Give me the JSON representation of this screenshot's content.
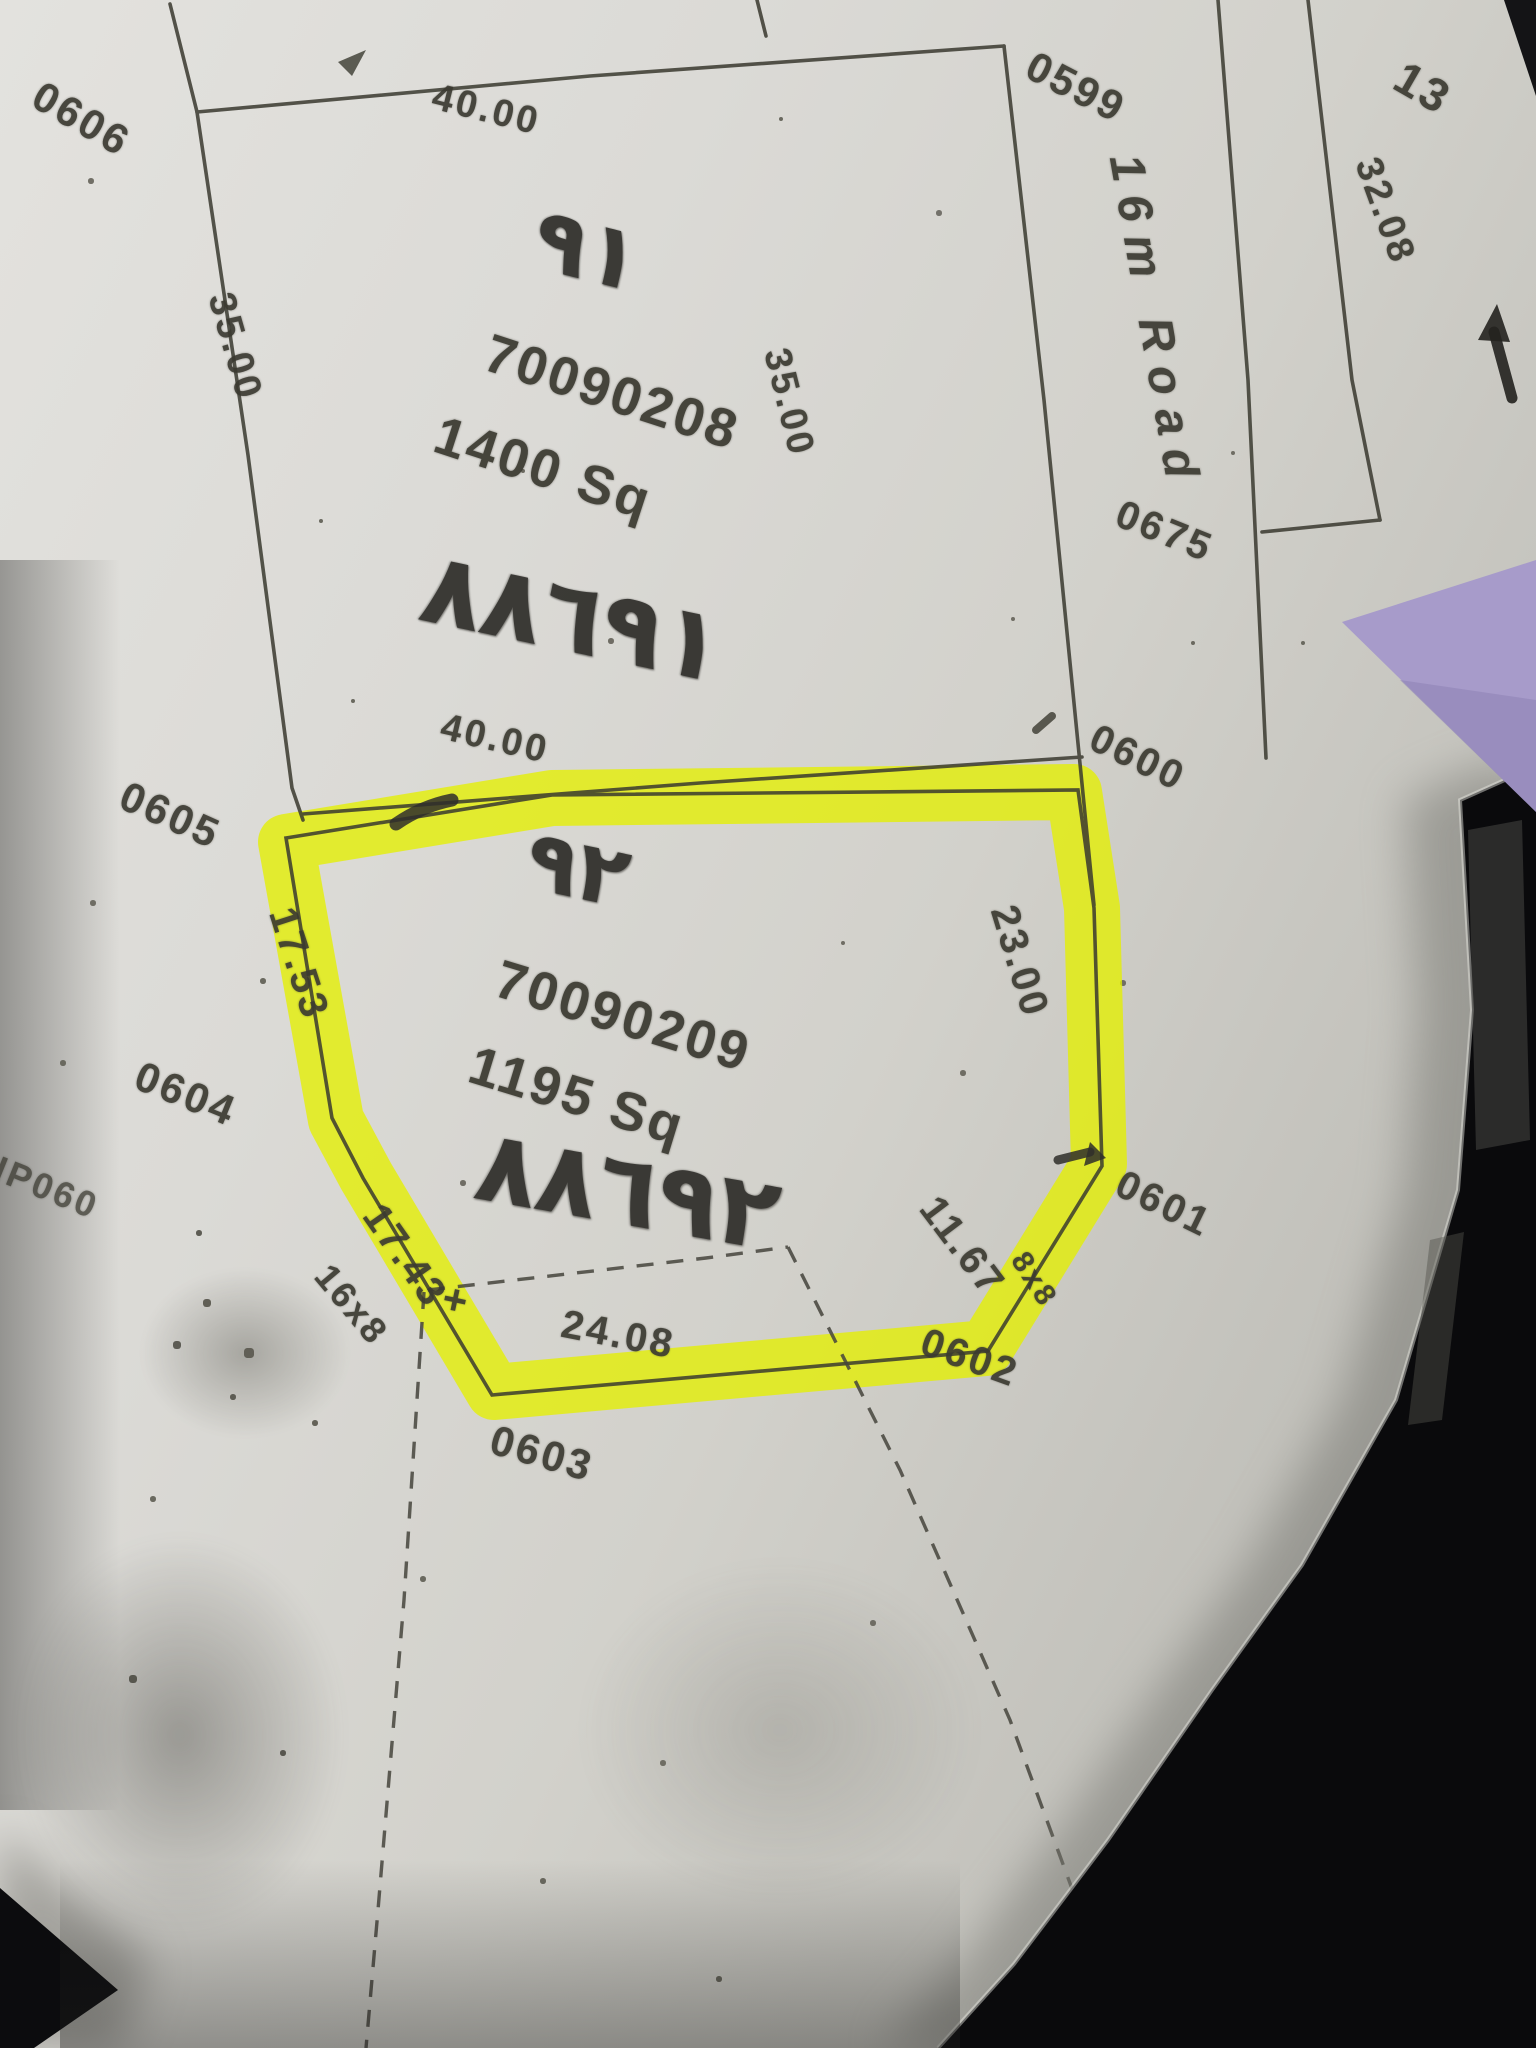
{
  "colors": {
    "highlight": "#e6f000",
    "paper": "#d8d7d3",
    "printed_ink": "#3b3a31",
    "pen_ink": "#2f2e2a",
    "purple_corner": "#a79bca",
    "photo_background": "#0b0b0d"
  },
  "road": {
    "label": "16m Road",
    "width_dim": "32.08"
  },
  "plot_91": {
    "number_handwritten": "٩١",
    "parcel_id": "70090208",
    "area": "1400 Sq",
    "note_handwritten": "٨٨٦٩١",
    "dim_top": "40.00",
    "dim_left": "35.00",
    "dim_right": "35.00",
    "dim_bottom": "40.00"
  },
  "plot_92": {
    "number_handwritten": "٩٢",
    "parcel_id": "70090209",
    "area": "1195 Sq",
    "note_handwritten": "٨٨٦٩٢",
    "highlight_color": "#e6f000",
    "dims": {
      "left": "17.53",
      "right": "23.00",
      "lower_left": "17.43",
      "bottom": "24.08",
      "lower_right": "11.67"
    }
  },
  "labels": {
    "pt_0606": "0606",
    "pt_0599": "0599",
    "pt_0605": "0605",
    "pt_0600": "0600",
    "pt_0604": "0604",
    "pt_0601": "0601",
    "pt_0602": "0602",
    "pt_0603": "0603",
    "pt_0675": "0675",
    "partial_13": "13",
    "cut_16x8": "16x8",
    "cut_8x8": "8x8",
    "ip060": "IP060",
    "plus": "+"
  }
}
